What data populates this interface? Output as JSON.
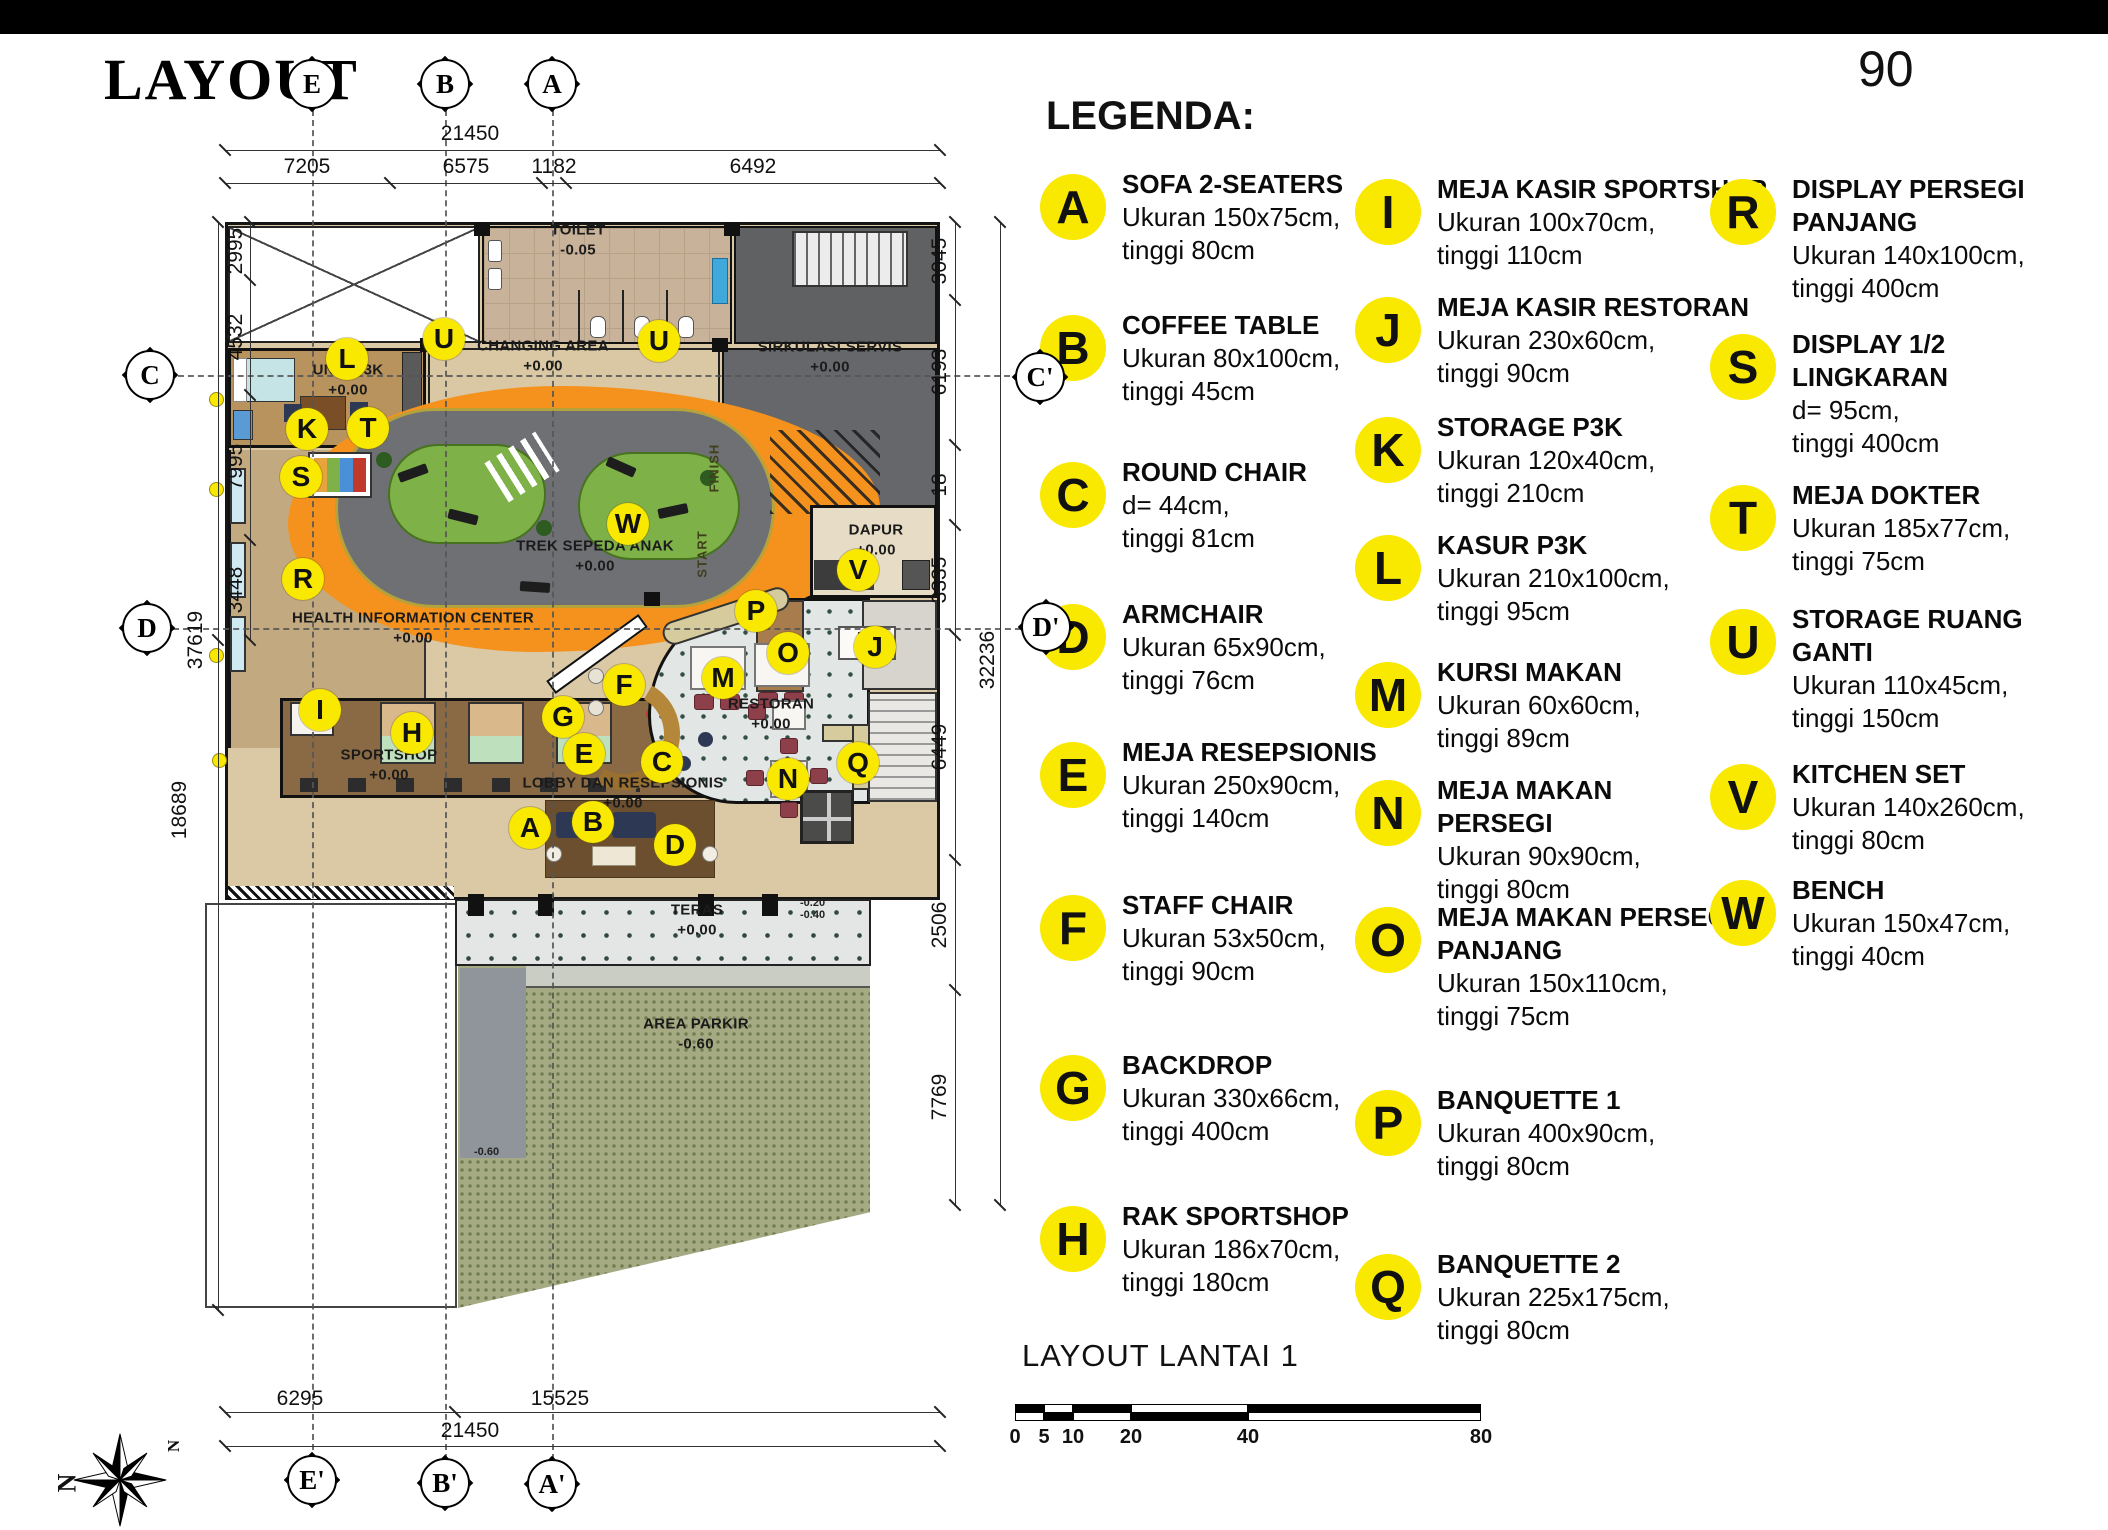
{
  "header": {
    "title": "LAYOUT",
    "page_number": "90"
  },
  "legend": {
    "heading": "LEGENDA:",
    "columns": [
      [
        {
          "letter": "A",
          "title": "SOFA 2-SEATERS",
          "dim": "Ukuran 150x75cm,",
          "height": "tinggi 80cm"
        },
        {
          "letter": "B",
          "title": "COFFEE TABLE",
          "dim": "Ukuran 80x100cm,",
          "height": "tinggi 45cm"
        },
        {
          "letter": "C",
          "title": "ROUND CHAIR",
          "dim": "d= 44cm,",
          "height": "tinggi 81cm"
        },
        {
          "letter": "D",
          "title": "ARMCHAIR",
          "dim": "Ukuran 65x90cm,",
          "height": "tinggi 76cm"
        },
        {
          "letter": "E",
          "title": "MEJA RESEPSIONIS",
          "dim": "Ukuran 250x90cm,",
          "height": "tinggi 140cm"
        },
        {
          "letter": "F",
          "title": "STAFF CHAIR",
          "dim": "Ukuran 53x50cm,",
          "height": "tinggi 90cm"
        },
        {
          "letter": "G",
          "title": "BACKDROP",
          "dim": "Ukuran 330x66cm,",
          "height": "tinggi 400cm"
        },
        {
          "letter": "H",
          "title": "RAK SPORTSHOP",
          "dim": "Ukuran 186x70cm,",
          "height": "tinggi 180cm"
        }
      ],
      [
        {
          "letter": "I",
          "title": "MEJA KASIR SPORTSHOP",
          "dim": "Ukuran 100x70cm,",
          "height": "tinggi 110cm"
        },
        {
          "letter": "J",
          "title": "MEJA KASIR RESTORAN",
          "dim": "Ukuran 230x60cm,",
          "height": "tinggi 90cm"
        },
        {
          "letter": "K",
          "title": "STORAGE P3K",
          "dim": "Ukuran 120x40cm,",
          "height": "tinggi 210cm"
        },
        {
          "letter": "L",
          "title": "KASUR P3K",
          "dim": "Ukuran 210x100cm,",
          "height": "tinggi 95cm"
        },
        {
          "letter": "M",
          "title": "KURSI MAKAN",
          "dim": "Ukuran 60x60cm,",
          "height": "tinggi 89cm"
        },
        {
          "letter": "N",
          "title": "MEJA MAKAN\nPERSEGI",
          "dim": "Ukuran 90x90cm,",
          "height": "tinggi 80cm"
        },
        {
          "letter": "O",
          "title": "MEJA MAKAN PERSEGI\nPANJANG",
          "dim": "Ukuran 150x110cm,",
          "height": "tinggi 75cm"
        },
        {
          "letter": "P",
          "title": "BANQUETTE 1",
          "dim": "Ukuran 400x90cm,",
          "height": "tinggi 80cm"
        },
        {
          "letter": "Q",
          "title": "BANQUETTE 2",
          "dim": "Ukuran 225x175cm,",
          "height": "tinggi 80cm"
        }
      ],
      [
        {
          "letter": "R",
          "title": "DISPLAY PERSEGI\nPANJANG",
          "dim": "Ukuran 140x100cm,",
          "height": "tinggi 400cm"
        },
        {
          "letter": "S",
          "title": "DISPLAY 1/2\nLINGKARAN",
          "dim": "d= 95cm,",
          "height": "tinggi 400cm"
        },
        {
          "letter": "T",
          "title": "MEJA DOKTER",
          "dim": "Ukuran 185x77cm,",
          "height": "tinggi 75cm"
        },
        {
          "letter": "U",
          "title": "STORAGE RUANG\nGANTI",
          "dim": "Ukuran 110x45cm,",
          "height": "tinggi 150cm"
        },
        {
          "letter": "V",
          "title": "KITCHEN SET",
          "dim": "Ukuran 140x260cm,",
          "height": "tinggi 80cm"
        },
        {
          "letter": "W",
          "title": "BENCH",
          "dim": "Ukuran 150x47cm,",
          "height": "tinggi 40cm"
        }
      ]
    ]
  },
  "plan": {
    "rooms": [
      {
        "id": "toilet",
        "name": "TOILET",
        "level": "-0.05"
      },
      {
        "id": "changing",
        "name": "CHANGING AREA",
        "level": "+0.00"
      },
      {
        "id": "sirkulasi",
        "name": "SIRKULASI SERVIS",
        "level": "+0.00"
      },
      {
        "id": "unitp3k",
        "name": "UNIT P3K",
        "level": "+0.00"
      },
      {
        "id": "trek",
        "name": "TREK SEPEDA ANAK",
        "level": "+0.00"
      },
      {
        "id": "hic",
        "name": "HEALTH INFORMATION CENTER",
        "level": "+0.00"
      },
      {
        "id": "sportshop",
        "name": "SPORTSHOP",
        "level": "+0.00"
      },
      {
        "id": "lobby",
        "name": "LOBBY DAN RESEPSIONIS",
        "level": "+0.00"
      },
      {
        "id": "dapur",
        "name": "DAPUR",
        "level": "+0.00"
      },
      {
        "id": "restoran",
        "name": "RESTORAN",
        "level": "+0.00"
      },
      {
        "id": "teras",
        "name": "TERAS",
        "level": "+0.00"
      },
      {
        "id": "parkir",
        "name": "AREA PARKIR",
        "level": "-0.60"
      }
    ],
    "track_labels": {
      "start": "START",
      "finish": "FINISH"
    },
    "spot_levels": [
      "-0.20",
      "-0.40",
      "-0.60"
    ],
    "markers": [
      "U",
      "U",
      "L",
      "K",
      "T",
      "S",
      "W",
      "R",
      "I",
      "H",
      "G",
      "F",
      "E",
      "C",
      "M",
      "A",
      "B",
      "D",
      "V",
      "P",
      "O",
      "J",
      "N",
      "Q"
    ],
    "grid_markers": {
      "top": [
        "E",
        "B",
        "A"
      ],
      "bottom": [
        "E'",
        "B'",
        "A'"
      ],
      "left": [
        "C",
        "D"
      ],
      "right": [
        "C'",
        "D'"
      ]
    },
    "dimensions": {
      "top_total": "21450",
      "top": [
        "7205",
        "6575",
        "1182",
        "6492"
      ],
      "left": [
        "2995",
        "4532",
        "7995",
        "3448"
      ],
      "left_lower": "18689",
      "left_total": "37619",
      "right": [
        "3045",
        "6193",
        "18",
        "3335",
        "6449",
        "2506",
        "7769"
      ],
      "right_total": "32236",
      "bottom": [
        "6295",
        "15525"
      ],
      "bottom_total": "21450"
    }
  },
  "footer": {
    "drawing_title": "LAYOUT LANTAI 1",
    "scale_labels": [
      "0",
      "5",
      "10",
      "20",
      "40",
      "80"
    ]
  },
  "compass": {
    "north_label": "N"
  }
}
